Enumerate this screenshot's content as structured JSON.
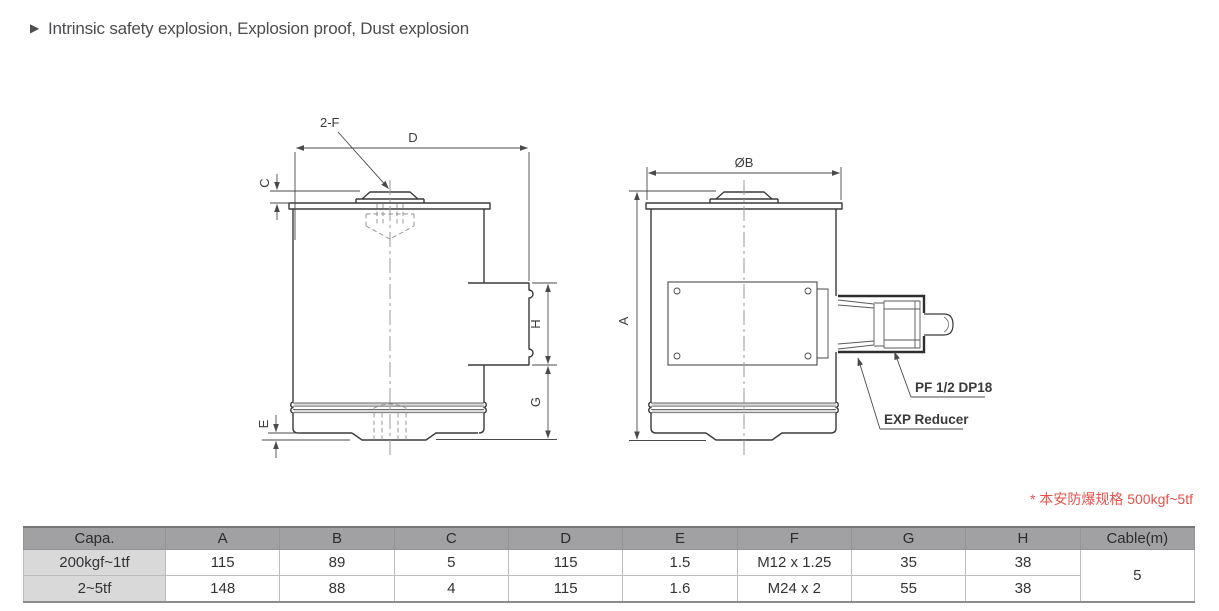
{
  "header": {
    "bullet": "▶",
    "title": "Intrinsic safety explosion, Explosion proof, Dust explosion"
  },
  "note": {
    "text": "* 本安防爆规格 500kgf~5tf",
    "color": "#e8514b"
  },
  "drawing": {
    "side_view": {
      "thread_callout": "2-F",
      "dim_d": "D",
      "dim_c": "C",
      "dim_e": "E",
      "dim_h": "H",
      "dim_g": "G"
    },
    "front_view": {
      "dim_a": "A",
      "dim_diameter_b": "ØB",
      "gland_thread_label": "PF 1/2 DP18",
      "reducer_label": "EXP Reducer"
    }
  },
  "table": {
    "columns": [
      "Capa.",
      "A",
      "B",
      "C",
      "D",
      "E",
      "F",
      "G",
      "H",
      "Cable(m)"
    ],
    "rows": [
      {
        "capa": "200kgf~1tf",
        "values": [
          "115",
          "89",
          "5",
          "115",
          "1.5",
          "M12 x 1.25",
          "35",
          "38"
        ]
      },
      {
        "capa": "2~5tf",
        "values": [
          "148",
          "88",
          "4",
          "115",
          "1.6",
          "M24 x 2",
          "55",
          "38"
        ]
      }
    ],
    "cable_value": "5"
  },
  "colors": {
    "line": "#3a3a3c",
    "dimension_line": "#4a4a4c",
    "hidden_line": "#8f8f91",
    "note_red": "#e8514b",
    "table_header_bg": "#a1a1a3",
    "table_label_bg": "#d9d9da"
  }
}
